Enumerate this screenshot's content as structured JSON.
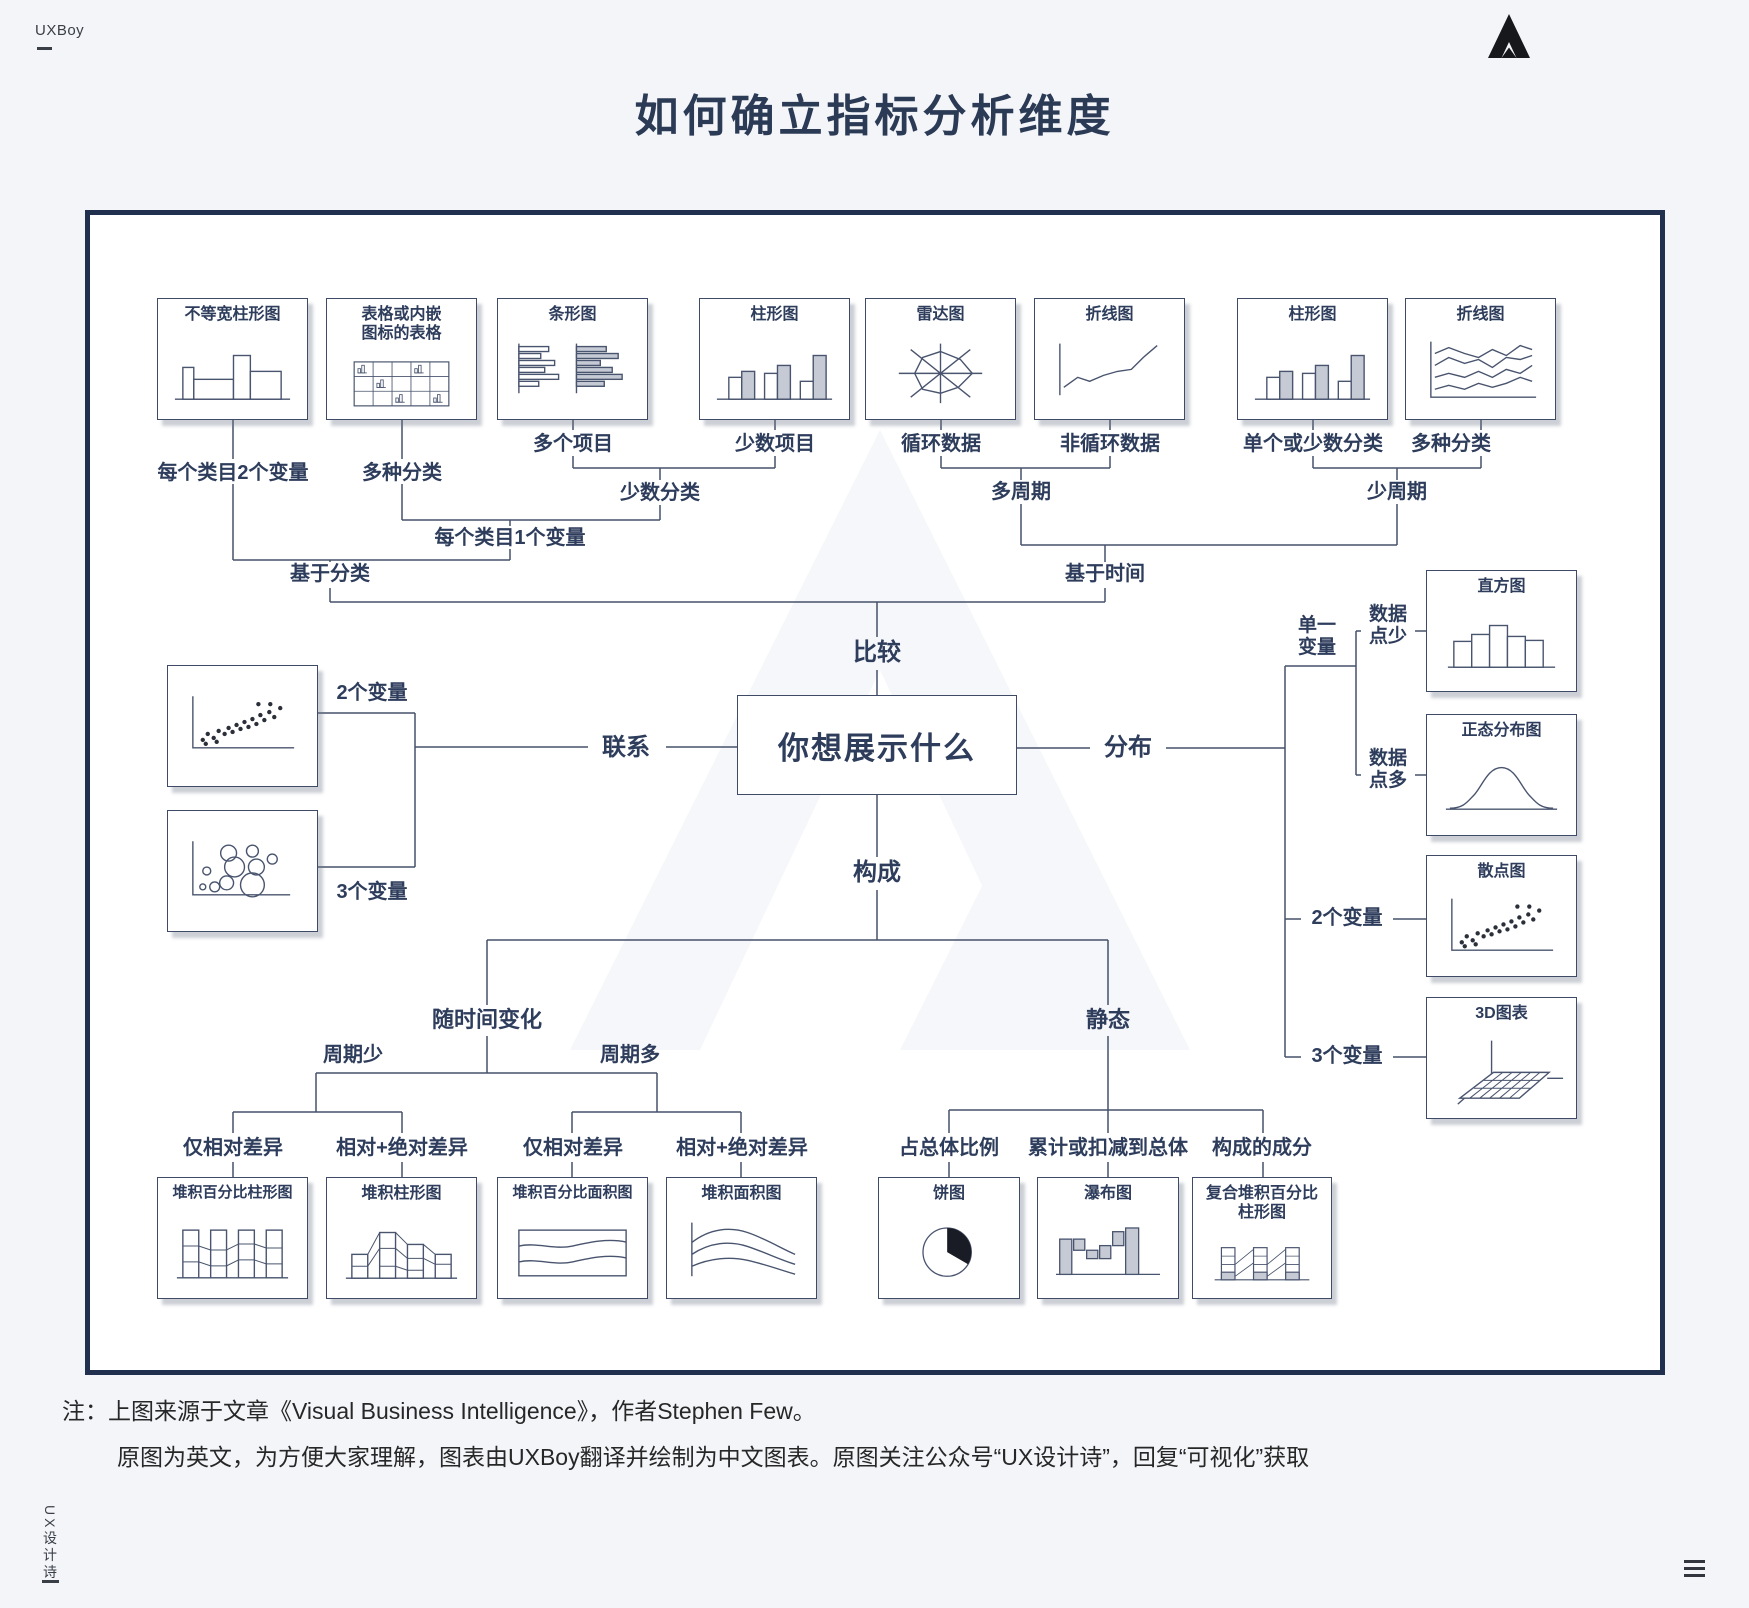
{
  "page": {
    "brand": "UXBoy",
    "title": "如何确立指标分析维度",
    "vertical_brand": "UX设计诗",
    "note_line1": "注：上图来源于文章《Visual Business Intelligence》，作者Stephen Few。",
    "note_line2": "原图为英文，为方便大家理解，图表由UXBoy翻译并绘制为中文图表。原图关注公众号“UX设计诗”，回复“可视化”获取"
  },
  "colors": {
    "background": "#f3f5f9",
    "box_border": "#22304f",
    "text": "#2e3d5c",
    "line": "#46526b"
  },
  "center": {
    "question": "你想展示什么"
  },
  "top_cards": [
    {
      "title": "不等宽柱形图",
      "thumb": "varwidth-column"
    },
    {
      "title": "表格或内嵌\n图标的表格",
      "thumb": "table-embedded"
    },
    {
      "title": "条形图",
      "thumb": "bar"
    },
    {
      "title": "柱形图",
      "thumb": "column-pair"
    },
    {
      "title": "雷达图",
      "thumb": "radar"
    },
    {
      "title": "折线图",
      "thumb": "line-single"
    },
    {
      "title": "柱形图",
      "thumb": "column-pair"
    },
    {
      "title": "折线图",
      "thumb": "line-multi"
    }
  ],
  "left_cards": [
    {
      "title": "",
      "thumb": "scatter"
    },
    {
      "title": "",
      "thumb": "bubble"
    }
  ],
  "right_cards": [
    {
      "title": "直方图",
      "thumb": "histogram"
    },
    {
      "title": "正态分布图",
      "thumb": "normal-curve"
    },
    {
      "title": "散点图",
      "thumb": "scatter"
    },
    {
      "title": "3D图表",
      "thumb": "surface-3d"
    }
  ],
  "bottom_cards": [
    {
      "title": "堆积百分比柱形图",
      "thumb": "stacked100-column"
    },
    {
      "title": "堆积柱形图",
      "thumb": "stacked-column"
    },
    {
      "title": "堆积百分比面积图",
      "thumb": "stacked100-area"
    },
    {
      "title": "堆积面积图",
      "thumb": "stacked-area"
    },
    {
      "title": "饼图",
      "thumb": "pie"
    },
    {
      "title": "瀑布图",
      "thumb": "waterfall"
    },
    {
      "title": "复合堆积百分比\n柱形图",
      "thumb": "compound-stacked"
    }
  ],
  "labels": {
    "a1": "每个类目2个变量",
    "a2": "多种分类",
    "a3": "多个项目",
    "a4": "少数项目",
    "a5": "循环数据",
    "a6": "非循环数据",
    "a7": "单个或少数分类",
    "a8": "多种分类",
    "m1": "少数分类",
    "m2": "多周期",
    "m3": "少周期",
    "m4": "每个类目1个变量",
    "m5": "基于分类",
    "m6": "基于时间",
    "d1": "比较",
    "d2": "联系",
    "d3": "分布",
    "d4": "构成",
    "lv2": "2个变量",
    "lv3": "3个变量",
    "rv1": "单一\n变量",
    "rp1": "数据\n点少",
    "rp2": "数据\n点多",
    "rv2": "2个变量",
    "rv3": "3个变量",
    "b1": "随时间变化",
    "b2": "静态",
    "p1": "周期少",
    "p2": "周期多",
    "q1": "仅相对差异",
    "q2": "相对+绝对差异",
    "q3": "仅相对差异",
    "q4": "相对+绝对差异",
    "q5": "占总体比例",
    "q6": "累计或扣减到总体",
    "q7": "构成的成分"
  }
}
